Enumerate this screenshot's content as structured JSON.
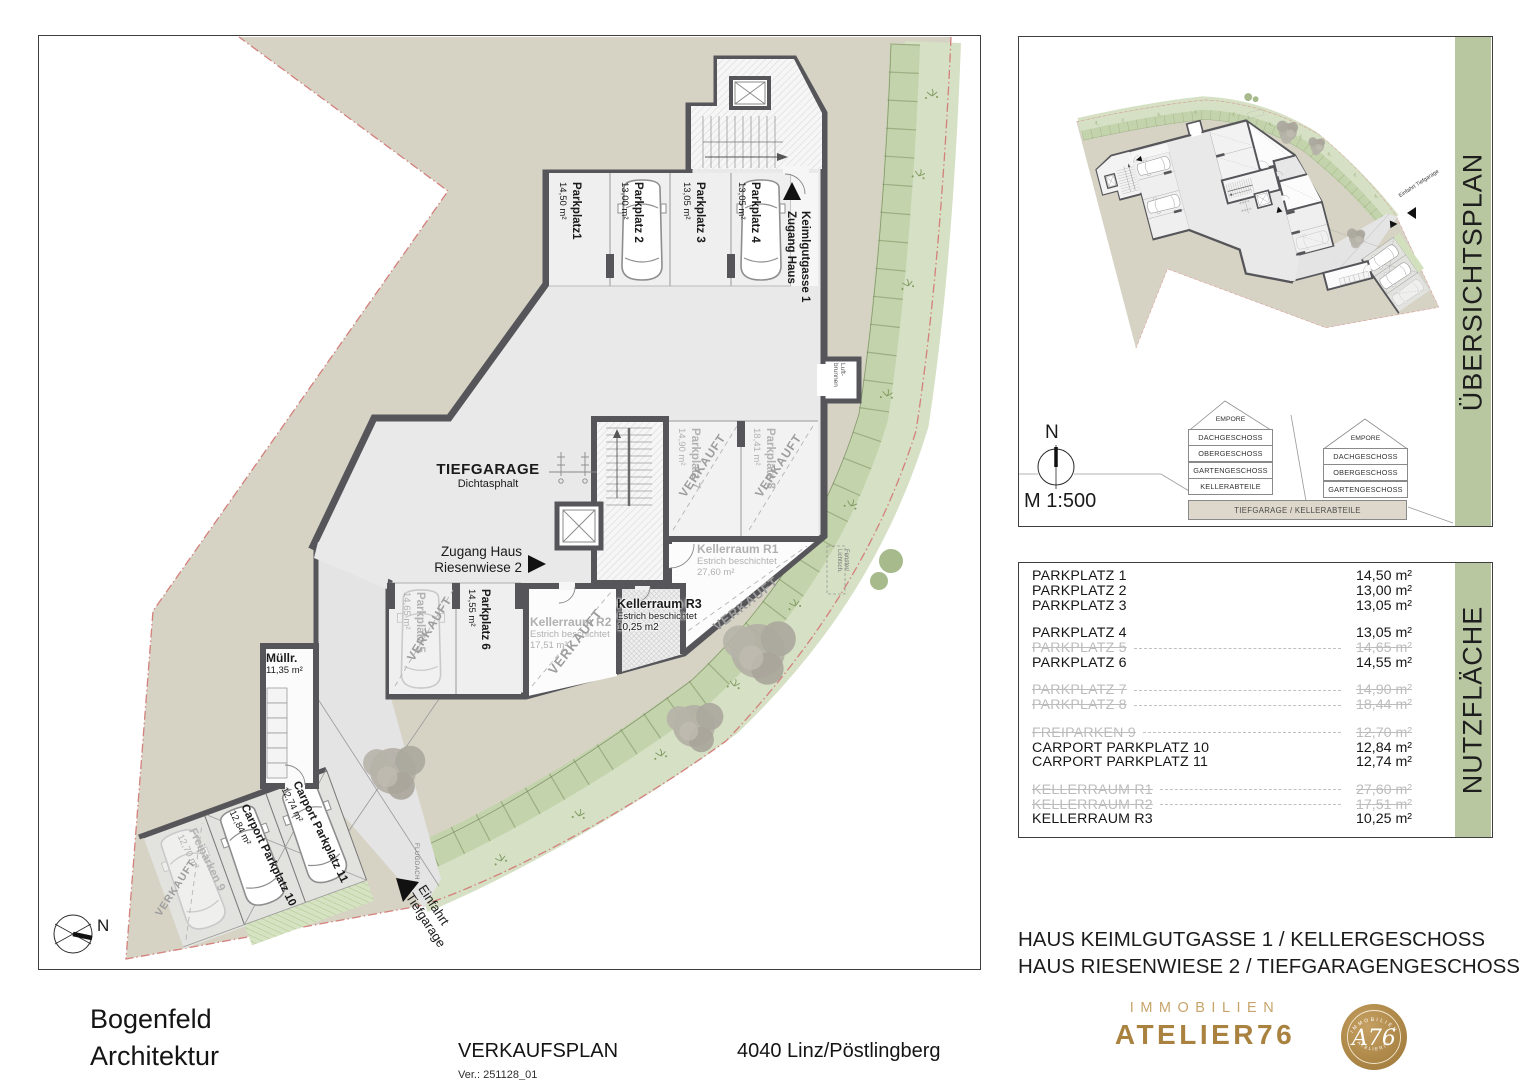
{
  "plan": {
    "tiefgarage": {
      "title": "TIEFGARAGE",
      "subtitle": "Dichtasphalt"
    },
    "stalls": [
      {
        "name": "Parkplatz1",
        "area": "14,50 m²"
      },
      {
        "name": "Parkplatz 2",
        "area": "13,00 m²"
      },
      {
        "name": "Parkplatz 3",
        "area": "13,05 m²"
      },
      {
        "name": "Parkplatz 4",
        "area": "13,05 m²"
      }
    ],
    "stall5": {
      "name": "Parkplatz 5",
      "area": "14,65 m²"
    },
    "stall6": {
      "name": "Parkplatz 6",
      "area": "14,55 m²"
    },
    "stall7": {
      "name": "Parkplatz 7",
      "area": "14,90 m²"
    },
    "stall8": {
      "name": "Parkplatz 8",
      "area": "18,41 m²"
    },
    "freiparken": {
      "name": "Freiparken 9",
      "area": "12,70 m²"
    },
    "carport10": {
      "name": "Carport Parkplatz 10",
      "area": "12,84 m²"
    },
    "carport11": {
      "name": "Carport Parkplatz 11",
      "area": "12,74 m²"
    },
    "r1": {
      "name": "Kellerraum R1",
      "sub": "Estrich beschichtet",
      "area": "27,60 m²"
    },
    "r2": {
      "name": "Kellerraum R2",
      "sub": "Estrich beschichtet",
      "area": "17,51 m²"
    },
    "r3": {
      "name": "Kellerraum R3",
      "sub": "Estrich beschichtet",
      "area": "10,25 m2"
    },
    "muell": {
      "name": "Müllr.",
      "area": "11,35 m²"
    },
    "zugang_keimlgutgasse": {
      "line1": "Zugang Haus",
      "line2": "Keimlgutgasse 1"
    },
    "zugang_riesenwiese": {
      "line1": "Zugang Haus",
      "line2": "Riesenwiese 2"
    },
    "einfahrt": {
      "line1": "Einfahrt",
      "line2": "Tiefgarage"
    },
    "luftbrunnen": {
      "line1": "Luft-",
      "line2": "brunnen"
    },
    "fenster": {
      "line1": "Fenster/",
      "line2": "Lichtsch."
    },
    "flugdach": "FLUGDACH",
    "verkauft": "VERKAUFT",
    "north": "N"
  },
  "overview": {
    "panel_title": "ÜBERSICHTSPLAN",
    "scale": "M 1:500",
    "north": "N",
    "mini_einfahrt": "Einfahrt Tiefgarage",
    "section": {
      "left": {
        "gable": "EMPORE",
        "floors": [
          "DACHGESCHOSS",
          "OBERGESCHOSS",
          "GARTENGESCHOSS",
          "KELLERABTEILE"
        ]
      },
      "right": {
        "gable": "EMPORE",
        "floors": [
          "DACHGESCHOSS",
          "OBERGESCHOSS",
          "GARTENGESCHOSS"
        ]
      },
      "base": "TIEFGARAGE / KELLERABTEILE"
    }
  },
  "nutzflaeche": {
    "panel_title": "NUTZFLÄCHE",
    "rows": [
      {
        "label": "PARKPLATZ 1",
        "value": "14,50 m²"
      },
      {
        "label": "PARKPLATZ 2",
        "value": "13,00 m²"
      },
      {
        "label": "PARKPLATZ 3",
        "value": "13,05 m²"
      },
      {
        "label": "PARKPLATZ 4",
        "value": "13,05 m²",
        "gap": true
      },
      {
        "label": "PARKPLATZ 5",
        "value": "14,65 m²",
        "sold": true
      },
      {
        "label": "PARKPLATZ 6",
        "value": "14,55 m²"
      },
      {
        "label": "PARKPLATZ 7",
        "value": "14,90 m²",
        "sold": true,
        "gap": true
      },
      {
        "label": "PARKPLATZ 8",
        "value": "18,44 m²",
        "sold": true
      },
      {
        "label": "FREIPARKEN 9",
        "value": "12,70 m²",
        "sold": true,
        "gap": true
      },
      {
        "label": "CARPORT PARKPLATZ 10",
        "value": "12,84 m²"
      },
      {
        "label": "CARPORT PARKPLATZ 11",
        "value": "12,74 m²"
      },
      {
        "label": "KELLERRAUM R1",
        "value": "27,60 m²",
        "sold": true,
        "gap": true
      },
      {
        "label": "KELLERRAUM R2",
        "value": "17,51 m²",
        "sold": true
      },
      {
        "label": "KELLERRAUM R3",
        "value": "10,25 m²"
      }
    ]
  },
  "titleblock": {
    "line1": "HAUS KEIMLGUTGASSE 1 / KELLERGESCHOSS",
    "line2": "HAUS RIESENWIESE 2 / TIEFGARAGENGESCHOSS"
  },
  "footer": {
    "architect_line1": "Bogenfeld",
    "architect_line2": "Architektur",
    "doc_title": "VERKAUFSPLAN",
    "version": "Ver.: 251128_01",
    "location": "4040 Linz/Pöstlingberg",
    "brand_top": "IMMOBILIEN",
    "brand_name": "ATELIER76",
    "badge_script": "A76",
    "badge_top": "IMMOBILIEN",
    "badge_bottom": "ATELIER76"
  },
  "colors": {
    "gold": "#a98240",
    "panel_green": "#b8c7a0",
    "site_beige": "#d6d3c5",
    "wall": "#56565a",
    "boundary_red": "#d4807c"
  }
}
